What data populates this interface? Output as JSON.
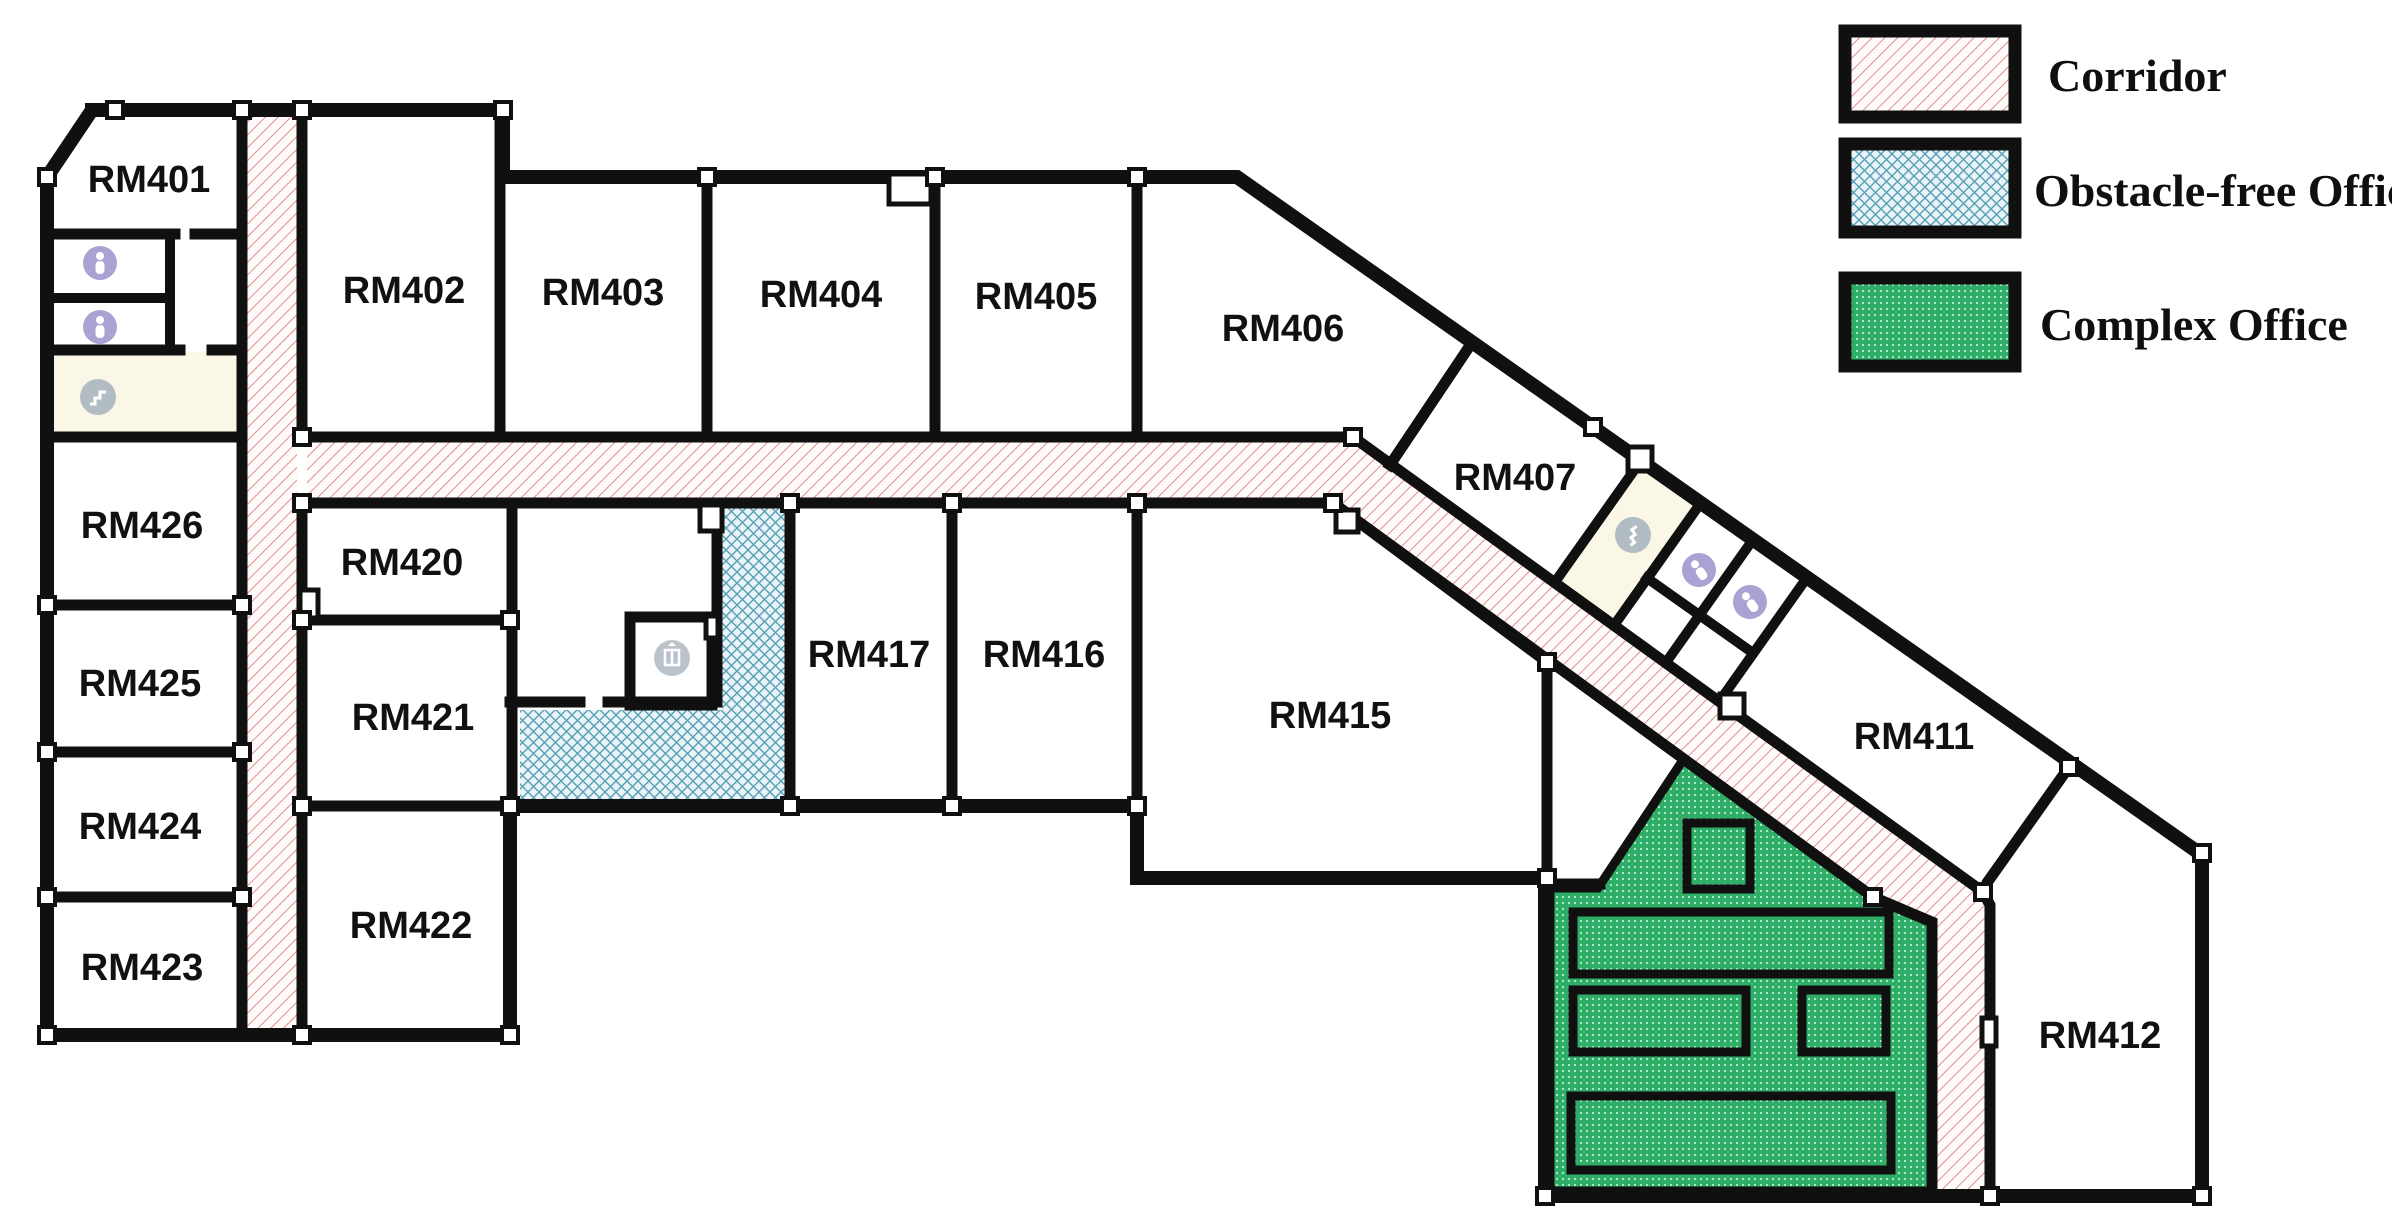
{
  "title": "Floor plan — 4th floor office layout",
  "legend": {
    "items": [
      {
        "label": "Corridor",
        "swatch": "red-diagonal-hatch"
      },
      {
        "label": "Obstacle-free Office",
        "swatch": "blue-crosshatch"
      },
      {
        "label": "Complex Office",
        "swatch": "green-dotted"
      }
    ]
  },
  "rooms": [
    {
      "label": "RM401"
    },
    {
      "label": "RM402"
    },
    {
      "label": "RM403"
    },
    {
      "label": "RM404"
    },
    {
      "label": "RM405"
    },
    {
      "label": "RM406"
    },
    {
      "label": "RM407"
    },
    {
      "label": "RM411"
    },
    {
      "label": "RM412"
    },
    {
      "label": "RM415"
    },
    {
      "label": "RM416"
    },
    {
      "label": "RM417"
    },
    {
      "label": "RM420"
    },
    {
      "label": "RM421"
    },
    {
      "label": "RM422"
    },
    {
      "label": "RM423"
    },
    {
      "label": "RM424"
    },
    {
      "label": "RM425"
    },
    {
      "label": "RM426"
    }
  ],
  "icons": [
    {
      "name": "restroom-person-icon",
      "count": 4
    },
    {
      "name": "stairs-icon",
      "count": 2
    },
    {
      "name": "elevator-icon",
      "count": 1
    }
  ],
  "colors": {
    "wall": "#101010",
    "corridor_line": "#d97b7b",
    "corridor_bg": "#fffbfa",
    "office_blue_bg": "#e9f3f8",
    "office_blue_line": "#559fb4",
    "complex_green": "#2fae68",
    "complex_green_dot": "#b9ecd0",
    "service_room_tint": "#fbf7e6",
    "icon_purple": "#948bc8",
    "icon_gray": "#a9b6bf"
  }
}
